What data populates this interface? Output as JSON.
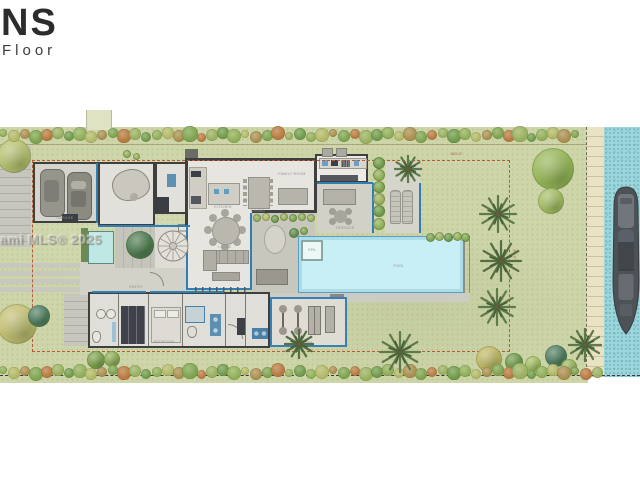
{
  "branding": {
    "logo_fragment": "NS",
    "floor_label": "Floor"
  },
  "watermark": {
    "text": "ami MLS® 2025"
  },
  "palette": {
    "lawn": "#cdd5a9",
    "water": "#9ad6dc",
    "dock": "#eae3c3",
    "wall": "#3f3f3f",
    "glass": "#2f7fb5",
    "floor": "#e7e5e0",
    "patio": "#cfcec5",
    "pool": "#c8eff5",
    "pool_edge": "#5b9fc0",
    "setback_dash": "#b5593c",
    "furniture": "#b5b3aa",
    "boat": "#4d5256"
  },
  "plan": {
    "room_labels": [
      {
        "text": "GARAGE",
        "x": 65,
        "y": 216
      },
      {
        "text": "KITCHEN",
        "x": 223,
        "y": 205
      },
      {
        "text": "DINING",
        "x": 258,
        "y": 209
      },
      {
        "text": "FAMILY ROOM",
        "x": 292,
        "y": 172
      },
      {
        "text": "LIVING",
        "x": 225,
        "y": 245
      },
      {
        "text": "TERRACE",
        "x": 345,
        "y": 226
      },
      {
        "text": "POOL",
        "x": 399,
        "y": 264
      },
      {
        "text": "SPA",
        "x": 312,
        "y": 248
      },
      {
        "text": "GYM",
        "x": 308,
        "y": 341
      },
      {
        "text": "BEDROOM",
        "x": 164,
        "y": 340
      },
      {
        "text": "ENTRY",
        "x": 136,
        "y": 285
      }
    ],
    "dimensions": [
      {
        "text": "150'-0\"",
        "x": 450,
        "y": 151,
        "rot": 0
      },
      {
        "text": "80'-0\"",
        "x": 510,
        "y": 252,
        "rot": 90
      }
    ]
  },
  "landscape": {
    "hedge_top": {
      "y": 135,
      "x_start": 3,
      "x_end": 582,
      "step": 11
    },
    "hedge_bottom": {
      "y": 372,
      "x_start": 3,
      "x_end": 600,
      "step": 11
    },
    "hedge_colors": [
      "#8fae57",
      "#b2b866",
      "#a98e4f",
      "#7da34e",
      "#b7793f",
      "#98b05f",
      "#6f9a4a"
    ],
    "trees": [
      {
        "x": 14,
        "y": 156,
        "r": 17,
        "c": "#b9c273"
      },
      {
        "x": 553,
        "y": 169,
        "r": 21,
        "c": "#97b65a"
      },
      {
        "x": 551,
        "y": 201,
        "r": 13,
        "c": "#a6bd66"
      },
      {
        "x": 17,
        "y": 324,
        "r": 20,
        "c": "#c4bf74"
      },
      {
        "x": 39,
        "y": 316,
        "r": 11,
        "c": "#4f7c63"
      },
      {
        "x": 96,
        "y": 360,
        "r": 9,
        "c": "#7fa34f"
      },
      {
        "x": 112,
        "y": 359,
        "r": 8,
        "c": "#8fae57"
      },
      {
        "x": 140,
        "y": 245,
        "r": 14,
        "c": "#4e7a52"
      },
      {
        "x": 489,
        "y": 359,
        "r": 13,
        "c": "#c0b765"
      },
      {
        "x": 514,
        "y": 362,
        "r": 9,
        "c": "#6f9a4a"
      },
      {
        "x": 556,
        "y": 356,
        "r": 11,
        "c": "#4f7c63"
      },
      {
        "x": 569,
        "y": 367,
        "r": 8,
        "c": "#97b65a"
      },
      {
        "x": 533,
        "y": 364,
        "r": 8,
        "c": "#a4bd62"
      }
    ],
    "palms": [
      {
        "x": 408,
        "y": 169,
        "r": 14,
        "c": "#5e7a48"
      },
      {
        "x": 498,
        "y": 214,
        "r": 19,
        "c": "#5e7a48"
      },
      {
        "x": 501,
        "y": 261,
        "r": 21,
        "c": "#566f42"
      },
      {
        "x": 497,
        "y": 307,
        "r": 19,
        "c": "#5e7a48"
      },
      {
        "x": 299,
        "y": 344,
        "r": 15,
        "c": "#566f42"
      },
      {
        "x": 400,
        "y": 352,
        "r": 21,
        "c": "#5e7a48"
      },
      {
        "x": 585,
        "y": 345,
        "r": 17,
        "c": "#5e7a48"
      }
    ],
    "shrubs": [
      {
        "x": 430,
        "y": 237,
        "r": 4.5,
        "c": "#7da34e"
      },
      {
        "x": 439,
        "y": 236,
        "r": 4.5,
        "c": "#98b05f"
      },
      {
        "x": 448,
        "y": 237,
        "r": 4.5,
        "c": "#6f9a4a"
      },
      {
        "x": 457,
        "y": 236,
        "r": 4.5,
        "c": "#8fae57"
      },
      {
        "x": 465,
        "y": 237,
        "r": 4.5,
        "c": "#7da34e"
      },
      {
        "x": 257,
        "y": 218,
        "r": 4,
        "c": "#8fae57"
      },
      {
        "x": 266,
        "y": 217,
        "r": 4,
        "c": "#b2b866"
      },
      {
        "x": 275,
        "y": 219,
        "r": 4,
        "c": "#6f9a4a"
      },
      {
        "x": 284,
        "y": 217,
        "r": 4,
        "c": "#98b05f"
      },
      {
        "x": 293,
        "y": 218,
        "r": 4,
        "c": "#7da34e"
      },
      {
        "x": 302,
        "y": 217,
        "r": 4,
        "c": "#8fae57"
      },
      {
        "x": 311,
        "y": 218,
        "r": 4,
        "c": "#98b05f"
      },
      {
        "x": 294,
        "y": 233,
        "r": 5,
        "c": "#5f8a4f"
      },
      {
        "x": 304,
        "y": 231,
        "r": 4,
        "c": "#7da34e"
      },
      {
        "x": 127,
        "y": 154,
        "r": 4,
        "c": "#8fae57"
      },
      {
        "x": 136,
        "y": 156,
        "r": 3.5,
        "c": "#98b05f"
      },
      {
        "x": 379,
        "y": 163,
        "r": 6,
        "c": "#6f9a4a"
      },
      {
        "x": 379,
        "y": 175,
        "r": 6,
        "c": "#8fae57"
      },
      {
        "x": 379,
        "y": 187,
        "r": 6,
        "c": "#7da34e"
      },
      {
        "x": 379,
        "y": 199,
        "r": 6,
        "c": "#98b05f"
      },
      {
        "x": 379,
        "y": 211,
        "r": 6,
        "c": "#6f9a4a"
      },
      {
        "x": 379,
        "y": 224,
        "r": 6,
        "c": "#8fae57"
      }
    ]
  }
}
